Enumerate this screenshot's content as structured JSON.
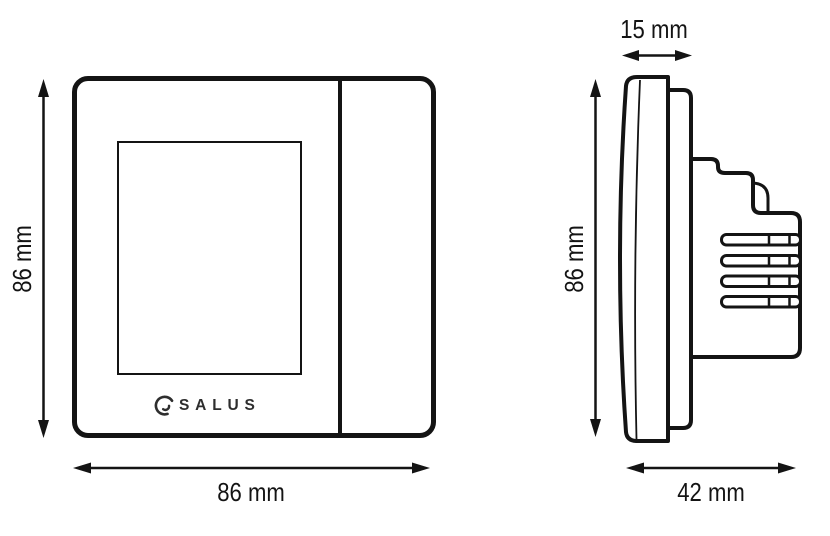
{
  "diagram": {
    "subject": "thermostat dimension drawing",
    "brand_logo": "SALUS",
    "front_view": {
      "height_dim": "86 mm",
      "width_dim": "86 mm"
    },
    "side_view": {
      "height_dim": "86 mm",
      "front_depth_dim": "15 mm",
      "total_depth_dim": "42 mm"
    },
    "colors": {
      "line": "#141414",
      "background": "#ffffff",
      "logo_text": "#2e2e2e"
    }
  }
}
